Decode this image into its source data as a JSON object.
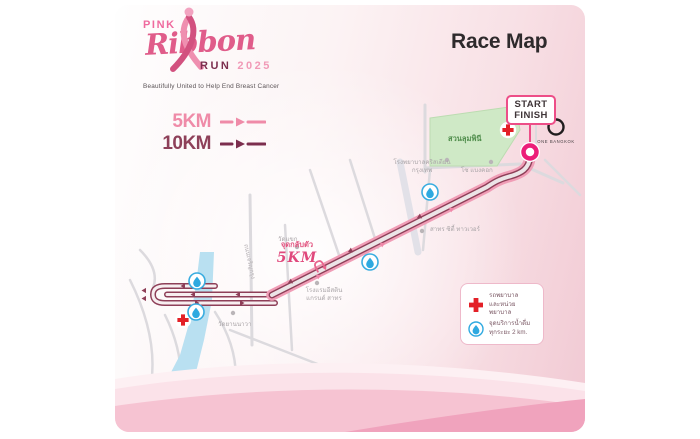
{
  "logo": {
    "pink": "PINK",
    "ribbon": "Ribbon",
    "run": "RUN",
    "year": "2025",
    "tagline": "Beautifully United to Help End Breast Cancer"
  },
  "title": "Race Map",
  "route_legend": {
    "k5": "5KM",
    "k10": "10KM"
  },
  "badge": {
    "line1": "START",
    "line2": "FINISH"
  },
  "map": {
    "park_label": "สวนลุมพินี",
    "one_bangkok_label": "One Bangkok",
    "turnaround": {
      "line1": "จุดกลับตัว",
      "line2": "5KM"
    },
    "landmarks": {
      "hospital": {
        "line1": "โรงพยาบาลคริสเตียน",
        "line2": "กรุงเทพ"
      },
      "so_bangkok": "โซ แบงคอก",
      "sathorn_tower": "สาทร ซิตี้ ทาวเวอร์",
      "wat_khaek": "วัดแขก",
      "eastin": {
        "line1": "โรงแรมอีสติน",
        "line2": "แกรนด์ สาทร"
      },
      "wat_yannawa": "วัดยานนาวา",
      "road": "ถนนเจริญกรุง"
    }
  },
  "info_legend": {
    "medical": {
      "line1": "รถพยาบาล",
      "line2": "และหน่วยพยาบาล"
    },
    "water": {
      "line1": "จุดบริการน้ำดื่ม",
      "line2": "ทุกระยะ 2 km."
    }
  },
  "colors": {
    "card_pink": "#f1c9d3",
    "route_band_pink": "#f09db6",
    "route_maroon": "#8e3f58",
    "accent_magenta": "#ec1e79",
    "park_green": "#cfe9c6",
    "river_blue": "#b9e0f1",
    "water_blue": "#2ea9e0",
    "cross_red": "#e32027",
    "km5_pink": "#ef8ba8",
    "km10_maroon": "#8e4059"
  }
}
